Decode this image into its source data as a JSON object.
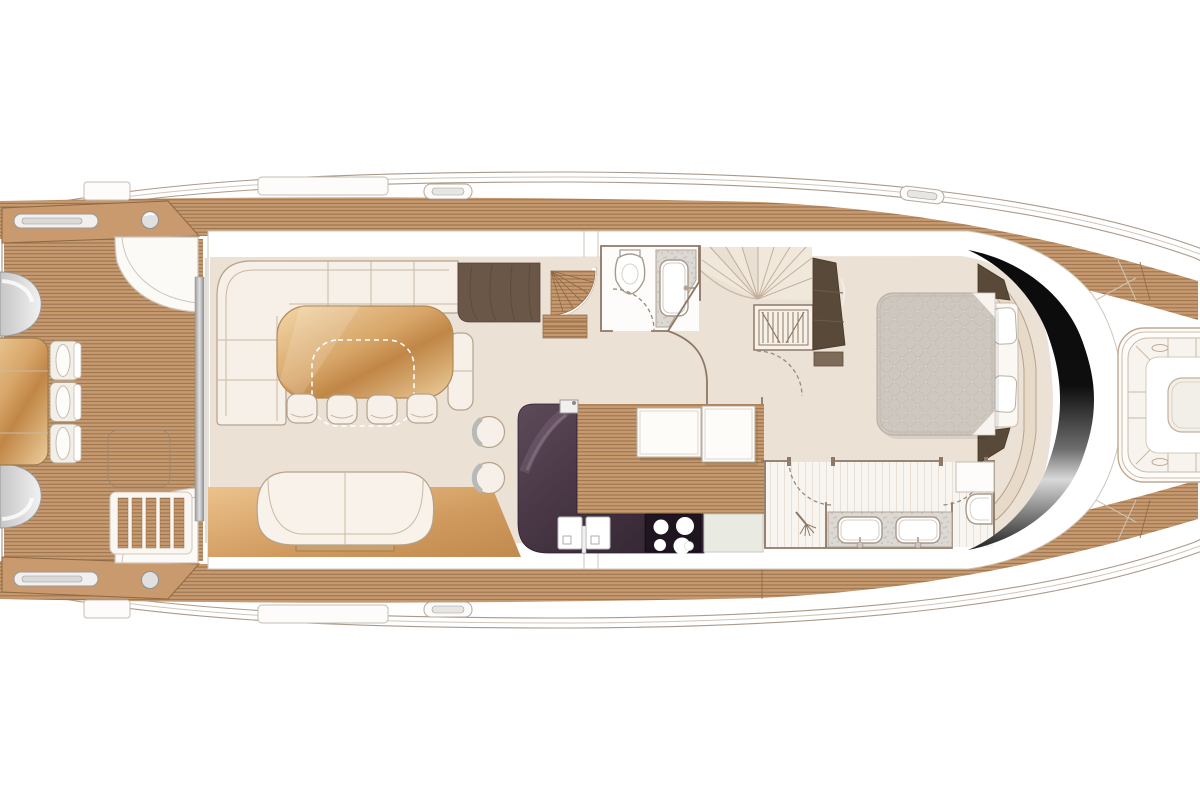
{
  "title": "motor-yacht-main-deck-floor-plan",
  "colors": {
    "hull_line": "#ab9a8a",
    "hull_line_faint": "#cfc5b8",
    "teak_base": "#c79a6f",
    "teak_stripe": "#9a734e",
    "wood_edge": "#8d6844",
    "interior_floor": "#ece1d5",
    "wall": "#8d7866",
    "furniture_fill": "#f6f0e8",
    "furniture_line": "#b5a28c",
    "seam": "#cbb9a4",
    "dark_wood": "#6b5748",
    "dark_wood_deep": "#594939",
    "wood_light": "#f3d7a8",
    "wood_mid": "#d7a568",
    "wood_deep": "#c08646",
    "counter_dark": "#2f2230",
    "counter_mid": "#5d4a5a",
    "cooktop": "#1f1520",
    "bed_quilt": "#cdc7bf",
    "quilt_line": "#b9b2a8",
    "glass_dark": "#0b0b0b",
    "glass_sheen": "#d9d9d9",
    "metal": "#9c9c9c",
    "speckle_bg": "#dcd8d3",
    "speckle_dot": "#b7b1ab",
    "stripe_line": "#d8ccbd",
    "pale_counter": "#e9ebe2",
    "door_dash": "#9b8a7a",
    "gray_seat": "#c6c6c6"
  },
  "plan": {
    "vessel": "motor yacht main deck plan",
    "areas": [
      {
        "id": "aft-deck",
        "label": "aft deck cockpit",
        "features": [
          "transom-lounge-seats",
          "cockpit-table",
          "cockpit-chairs",
          "deck-hatch",
          "side-boarding-steps",
          "wet-bar-console",
          "boarding-platforms"
        ]
      },
      {
        "id": "salon",
        "label": "salon",
        "features": [
          "u-shaped-sofa",
          "dining-table",
          "dining-stools",
          "end-seat",
          "sideboard",
          "round-lounge-chairs",
          "aft-sofa",
          "wood-floor"
        ]
      },
      {
        "id": "galley",
        "label": "galley",
        "features": [
          "l-shaped-counter",
          "double-sink",
          "cooktop",
          "island-units",
          "worktop"
        ]
      },
      {
        "id": "day-head",
        "label": "day head",
        "features": [
          "toilet",
          "vanity-basin"
        ]
      },
      {
        "id": "stairs",
        "label": "staircases",
        "features": [
          "curved-stairs-down",
          "fan-stairs-up",
          "louvered-locker",
          "entry-wardrobe"
        ]
      },
      {
        "id": "master-cabin",
        "label": "forward master cabin",
        "features": [
          "double-bed",
          "pillows",
          "bedside-cabinets",
          "headboard-surround"
        ]
      },
      {
        "id": "master-bathroom",
        "label": "master bathroom",
        "features": [
          "twin-sink-vanity",
          "shower",
          "toilet",
          "storage-cabinet"
        ]
      },
      {
        "id": "windshield",
        "label": "wraparound windshield",
        "features": []
      },
      {
        "id": "foredeck",
        "label": "foredeck",
        "features": [
          "bow-seating",
          "bow-table",
          "cup-holders",
          "deck-cleats"
        ]
      }
    ]
  }
}
